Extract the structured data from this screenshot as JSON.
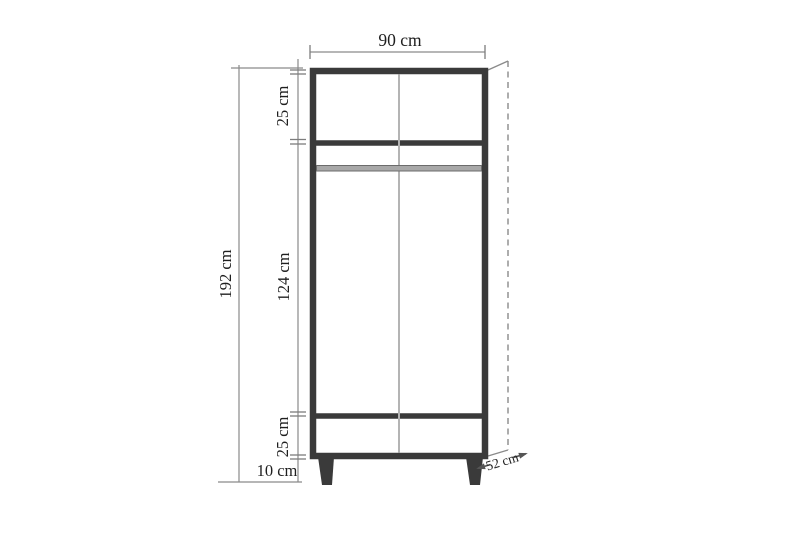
{
  "dimensions": {
    "width": "90 cm",
    "total_height": "192 cm",
    "top_section_height": "25 cm",
    "middle_section_height": "124 cm",
    "bottom_section_height": "25 cm",
    "leg_height": "10 cm",
    "depth": "52 cm"
  },
  "colors": {
    "background": "#ffffff",
    "cabinet_stroke": "#3a3a3a",
    "dimension_line": "#8a8a8a",
    "center_divider": "#b4b4b4",
    "rod_fill": "#a8a8a8",
    "text": "#1f1f1f"
  }
}
